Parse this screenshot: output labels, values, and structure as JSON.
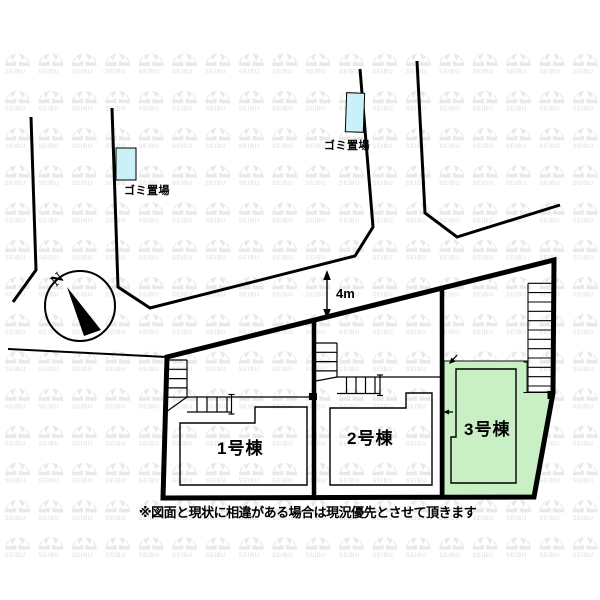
{
  "map": {
    "title": "site-plan",
    "garbage_labels": [
      "ゴミ置場",
      "ゴミ置場"
    ],
    "road_width_label": "4m",
    "compass": {
      "north_label": "N"
    },
    "plots": [
      {
        "label": "1号棟"
      },
      {
        "label": "2号棟"
      },
      {
        "label": "3号棟"
      }
    ],
    "note": "※図面と現状に相違がある場合は現況優先とさせて頂きます",
    "watermark_text": "SEIBU",
    "colors": {
      "garbage_fill": "#c9f1f7",
      "plot3_fill": "#c9efc5",
      "line": "#000000",
      "watermark": "#e9e9e9",
      "background": "#ffffff"
    }
  }
}
